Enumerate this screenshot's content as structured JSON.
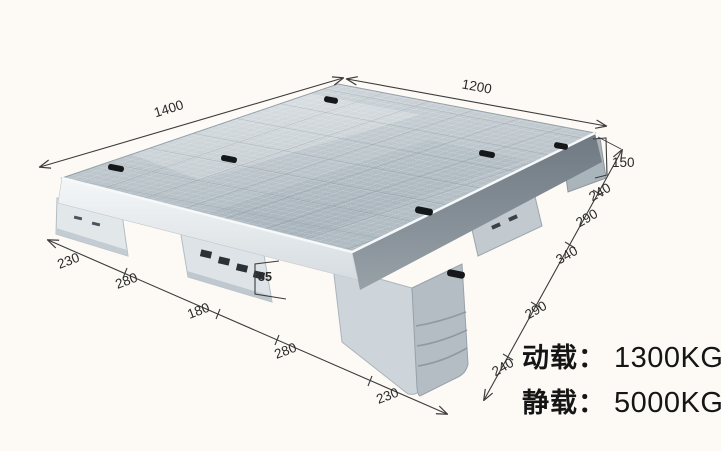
{
  "annotations": {
    "length_label": "1400",
    "width_label": "1200",
    "height_label": "150",
    "fork_height_label": "85",
    "right_edge_segments": [
      "240",
      "290",
      "340",
      "290",
      "240"
    ],
    "bottom_edge_segments": [
      "230",
      "280",
      "180",
      "280",
      "230"
    ]
  },
  "loads": {
    "dynamic_label": "动载：",
    "dynamic_value": "1300KG",
    "static_label": "静载：",
    "static_value": "5000KG"
  },
  "subject": {
    "type": "plastic-grid-pallet-photo",
    "body_color": "#c5ced4",
    "slot_color": "#15181a",
    "background_color": "#fdfaf5"
  }
}
